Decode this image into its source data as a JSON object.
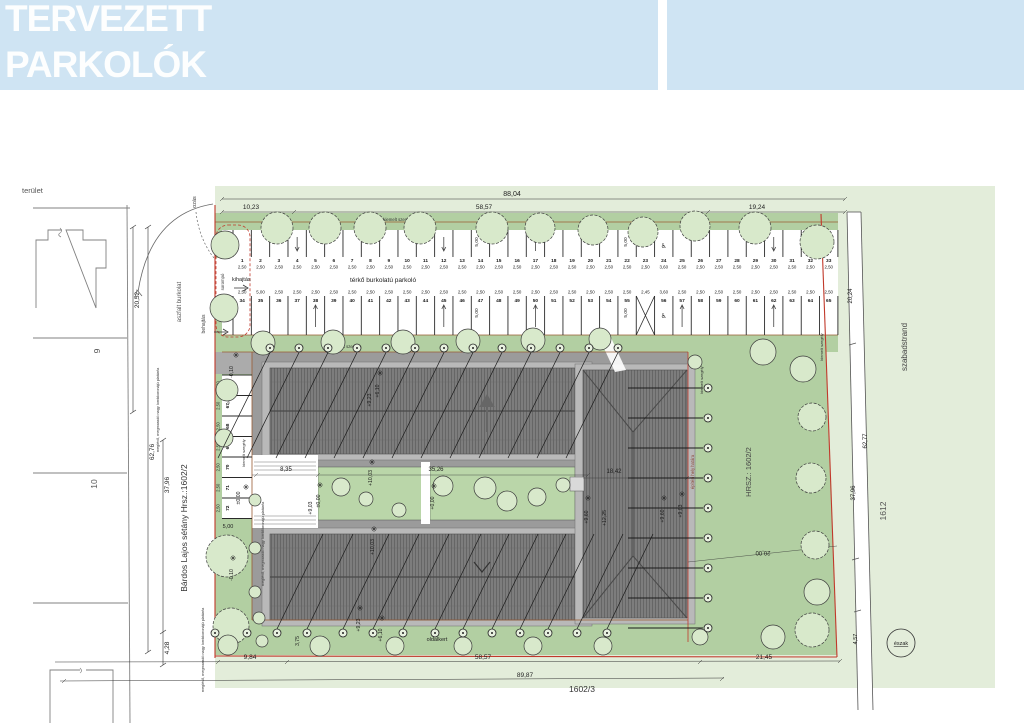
{
  "header": {
    "line1": "TERVEZETT",
    "line2": "PARKOLÓK",
    "bg": "#cfe4f3"
  },
  "watermark": "GDN",
  "labels": {
    "terulet": "terület",
    "ozas": "ozás",
    "kihajtas": "kihajtás",
    "behajtas": "behajtás",
    "sorompo": "sorompó",
    "terko": "térkő burkolatú parkoló",
    "kiemelt": "kiemelt szegély",
    "elokert": "előkert",
    "oldalkert": "oldalkert",
    "platan": "meglévő, megmaradó nagy lombkoronájú platánfa",
    "aszfalt": "aszfalt burkolat",
    "bardos": "Bárdos Lajos sétány Hrsz.:1602/2",
    "hrsz": "HRSZ.: 1602/2",
    "epitesi": "építési hely határa",
    "szabadstrand": "szabadstrand",
    "eszak": "észak"
  },
  "parcels": {
    "p9": "9",
    "p10": "10",
    "p1612": "1612",
    "p16023": "1602/3"
  },
  "dims": {
    "d8804": "88,04",
    "d1023": "10,23",
    "d5857": "58,57",
    "d1924": "19,24",
    "d2052": "20,52",
    "d6276": "62,76",
    "d3796": "37,96",
    "d428": "4,28",
    "d984": "9,84",
    "d2145": "21,45",
    "d8987": "89,87",
    "d2024": "20,24",
    "d6277": "62,77",
    "d457": "4,57",
    "d2000": "20,00",
    "d835": "8,35",
    "d3526": "35,26",
    "d1842": "18,42",
    "d500": "5,00",
    "d375": "3,75"
  },
  "elevations": [
    {
      "x": 233,
      "y": 372,
      "v": "-0,10"
    },
    {
      "x": 379,
      "y": 391,
      "v": "+6,10"
    },
    {
      "x": 371,
      "y": 400,
      "v": "+9,23"
    },
    {
      "x": 320,
      "y": 501,
      "v": "±0,00"
    },
    {
      "x": 312,
      "y": 508,
      "v": "+9,03"
    },
    {
      "x": 434,
      "y": 503,
      "v": "+0,00"
    },
    {
      "x": 372,
      "y": 478,
      "v": "+10,03"
    },
    {
      "x": 374,
      "y": 547,
      "v": "+10,03"
    },
    {
      "x": 360,
      "y": 625,
      "v": "+9,23"
    },
    {
      "x": 382,
      "y": 635,
      "v": "+6,10"
    },
    {
      "x": 588,
      "y": 517,
      "v": "+9,60"
    },
    {
      "x": 606,
      "y": 518,
      "v": "+12,25"
    },
    {
      "x": 664,
      "y": 516,
      "v": "+9,60"
    },
    {
      "x": 682,
      "y": 511,
      "v": "+9,03"
    },
    {
      "x": 233,
      "y": 575,
      "v": "-0,10"
    },
    {
      "x": 240,
      "y": 498,
      "v": "±0,00"
    }
  ],
  "parking": {
    "row_a": {
      "numbers": [
        "1",
        "2",
        "3",
        "4",
        "5",
        "6",
        "7",
        "8",
        "9",
        "10",
        "11",
        "12",
        "13",
        "14",
        "15",
        "16",
        "17",
        "18",
        "19",
        "20",
        "21",
        "22",
        "23",
        "24",
        "25",
        "26",
        "27",
        "28",
        "29",
        "30",
        "31",
        "32",
        "33"
      ],
      "dims": [
        "2,50",
        "2,50",
        "2,50",
        "2,50",
        "2,50",
        "2,50",
        "2,50",
        "2,50",
        "2,50",
        "2,50",
        "2,50",
        "2,50",
        "2,50",
        "2,50",
        "2,50",
        "2,50",
        "2,50",
        "2,50",
        "2,50",
        "2,50",
        "2,50",
        "2,50",
        "2,50",
        "3,60",
        "2,50",
        "2,50",
        "2,50",
        "2,50",
        "2,50",
        "2,50",
        "2,50",
        "2,50",
        "2,50"
      ],
      "disabled": [
        "24"
      ]
    },
    "row_b": {
      "cells": [
        "34",
        "35",
        "36",
        "37",
        "38",
        "39",
        "40",
        "41",
        "42",
        "43",
        "44",
        "45",
        "46",
        "47",
        "48",
        "49",
        "50",
        "51",
        "52",
        "53",
        "54",
        "55",
        "X",
        "56",
        "57",
        "58",
        "59",
        "60",
        "61",
        "62",
        "63",
        "64",
        "65"
      ],
      "dims": [
        "2,50",
        "5,00",
        "2,50",
        "2,50",
        "2,50",
        "2,50",
        "2,50",
        "2,50",
        "2,50",
        "2,50",
        "2,50",
        "2,50",
        "2,50",
        "2,50",
        "2,50",
        "2,50",
        "2,50",
        "2,50",
        "2,50",
        "2,50",
        "2,50",
        "2,50",
        "2,45",
        "3,60",
        "2,50",
        "2,50",
        "2,50",
        "2,50",
        "2,50",
        "2,50",
        "2,50",
        "2,50",
        "2,50"
      ],
      "disabled": [
        "56"
      ]
    },
    "row_c": {
      "numbers": [
        "66",
        "67",
        "68",
        "69",
        "70",
        "71",
        "72"
      ],
      "dims": [
        "2,50",
        "2,50",
        "2,50",
        "2,50",
        "2,50",
        "2,50",
        "2,50"
      ]
    }
  },
  "symbols": {
    "wheelchair": "♿"
  },
  "colors": {
    "pale_green": "#e3edda",
    "lawn": "#b2cfa2",
    "courtyard": "#bad6a9",
    "paved": "#9b9b9b",
    "roof": "#7d7d7d",
    "roof_hatch": "#5c5c5c",
    "eaves": "#b9b9b9",
    "boundary_red": "#c1392b",
    "curb_brown": "#9a5b33",
    "tree_fill": "#d8e9cb",
    "header_bg": "#cfe4f3"
  }
}
